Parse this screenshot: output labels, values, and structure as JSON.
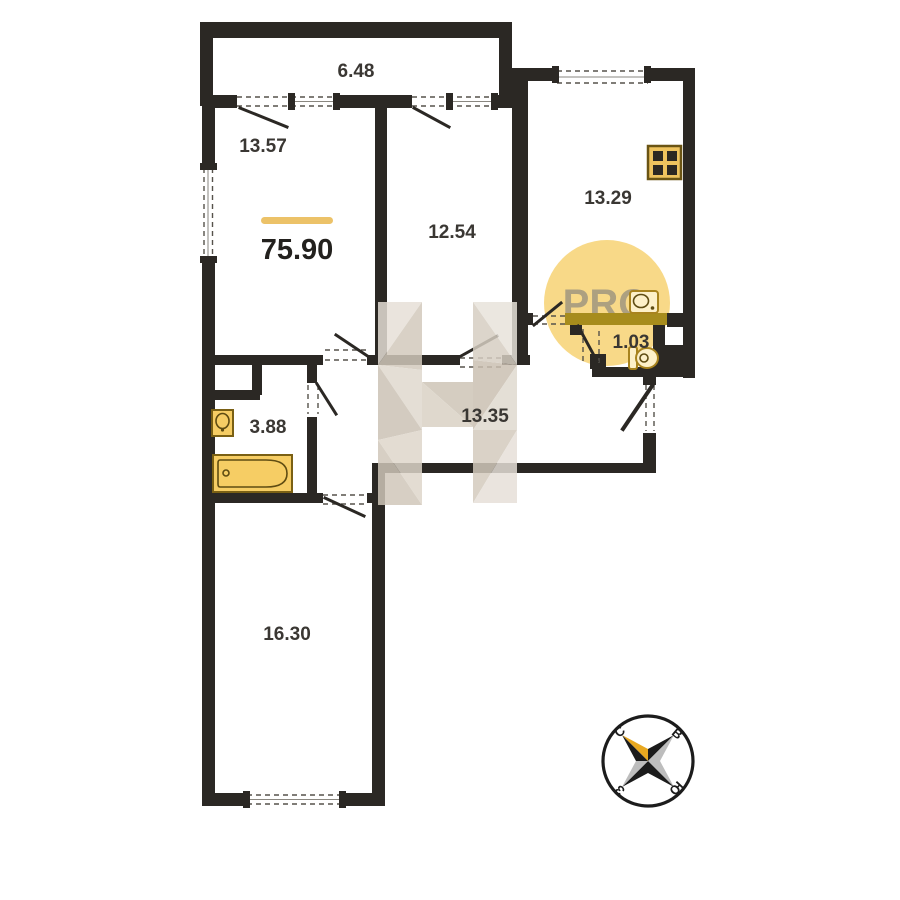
{
  "plan": {
    "title_hint": "apartment floor plan",
    "total_area": {
      "value": "75.90"
    },
    "rooms": [
      {
        "name": "balcony",
        "area": "6.48"
      },
      {
        "name": "room-1",
        "area": "13.57"
      },
      {
        "name": "room-2",
        "area": "12.54"
      },
      {
        "name": "kitchen",
        "area": "13.29"
      },
      {
        "name": "wc",
        "area": "1.03"
      },
      {
        "name": "bathroom",
        "area": "3.88"
      },
      {
        "name": "hallway",
        "area": "13.35"
      },
      {
        "name": "room-3",
        "area": "16.30"
      }
    ],
    "fixtures": [
      "bathtub",
      "wash-basin",
      "toilet",
      "kitchen-sink",
      "stove"
    ]
  },
  "watermark": {
    "pro_label": "PRO",
    "letter": "Н"
  },
  "compass": {
    "north": "С",
    "east": "В",
    "west": "З",
    "south": "Ю"
  },
  "colors": {
    "wall": "#2b2824",
    "accent_bar": "#ecc268",
    "highlight_wall": "#a78c1c",
    "pro_circle": "#f8d782",
    "pro_text": "#8e897e",
    "watermark_beige": "#d8d0c4",
    "fixture_fill": "#f6cd64",
    "fixture_light": "#fdf0c8",
    "fixture_outline": "#7a6014",
    "label": "#3a3733",
    "compass_gold": "#e8a820",
    "compass_silver": "#bdbdbd"
  }
}
